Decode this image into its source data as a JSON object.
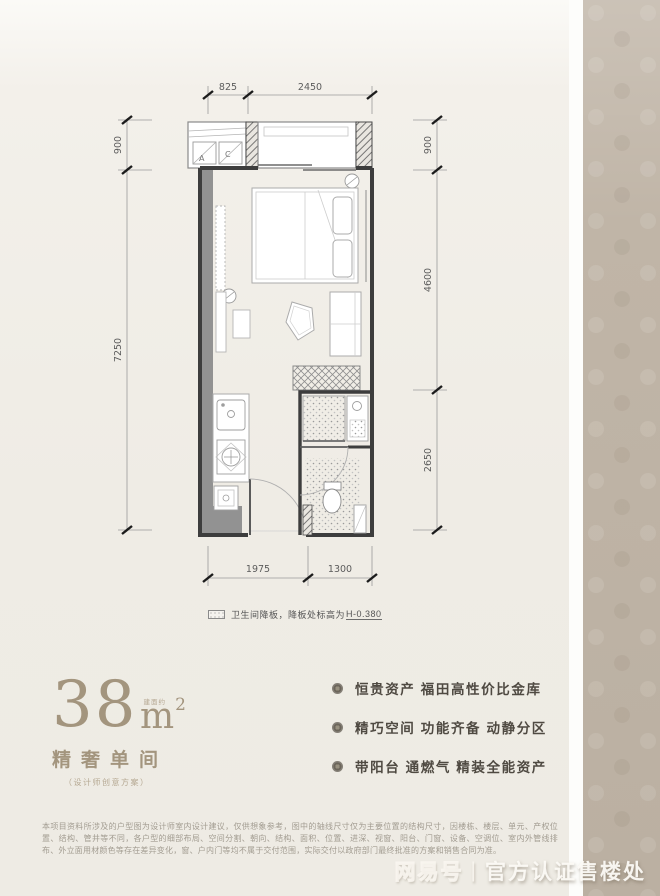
{
  "plan": {
    "dims": {
      "top": [
        "825",
        "2450"
      ],
      "left": [
        "900",
        "7250"
      ],
      "right": [
        "900",
        "4600",
        "2650"
      ],
      "bottom": [
        "1975",
        "1300"
      ]
    },
    "ac_unit_labels": [
      "A",
      "C"
    ],
    "legend_text": "卫生间降板，降板处标高为",
    "legend_value": "H-0.380"
  },
  "info": {
    "area_qualifier": "建面约",
    "area_value": "38",
    "area_unit": "m",
    "area_exponent": "2",
    "room_title": "精奢单间",
    "room_subtitle": "（设计师创意方案）",
    "selling_points": [
      "恒贵资产 福田高性价比金库",
      "精巧空间 功能齐备 动静分区",
      "带阳台 通燃气 精装全能资产"
    ]
  },
  "disclaimer": "本项目资料所涉及的户型图为设计师室内设计建议，仅供想象参考，图中的轴线尺寸仅为主要位置的结构尺寸，因楼栋、楼层、单元、产权位置、结构、管井等不同，各户型的细部布局、空间分割、朝向、结构、面积、位置、进深、视窗、阳台、门窗、设备、空调位、室内外管线排布、外立面用材颜色等存在差异变化，窗、户内门等均不属于交付范围，实际交付以政府部门最终批准的方案和销售合同为准。",
  "watermark": {
    "brand": "网易号",
    "separator": "|",
    "label": "官方认证售楼处"
  },
  "colors": {
    "accent_bronze": "#a3957e",
    "band_tan": "#c0b5a7",
    "wall_dark": "#3d3d3d"
  }
}
